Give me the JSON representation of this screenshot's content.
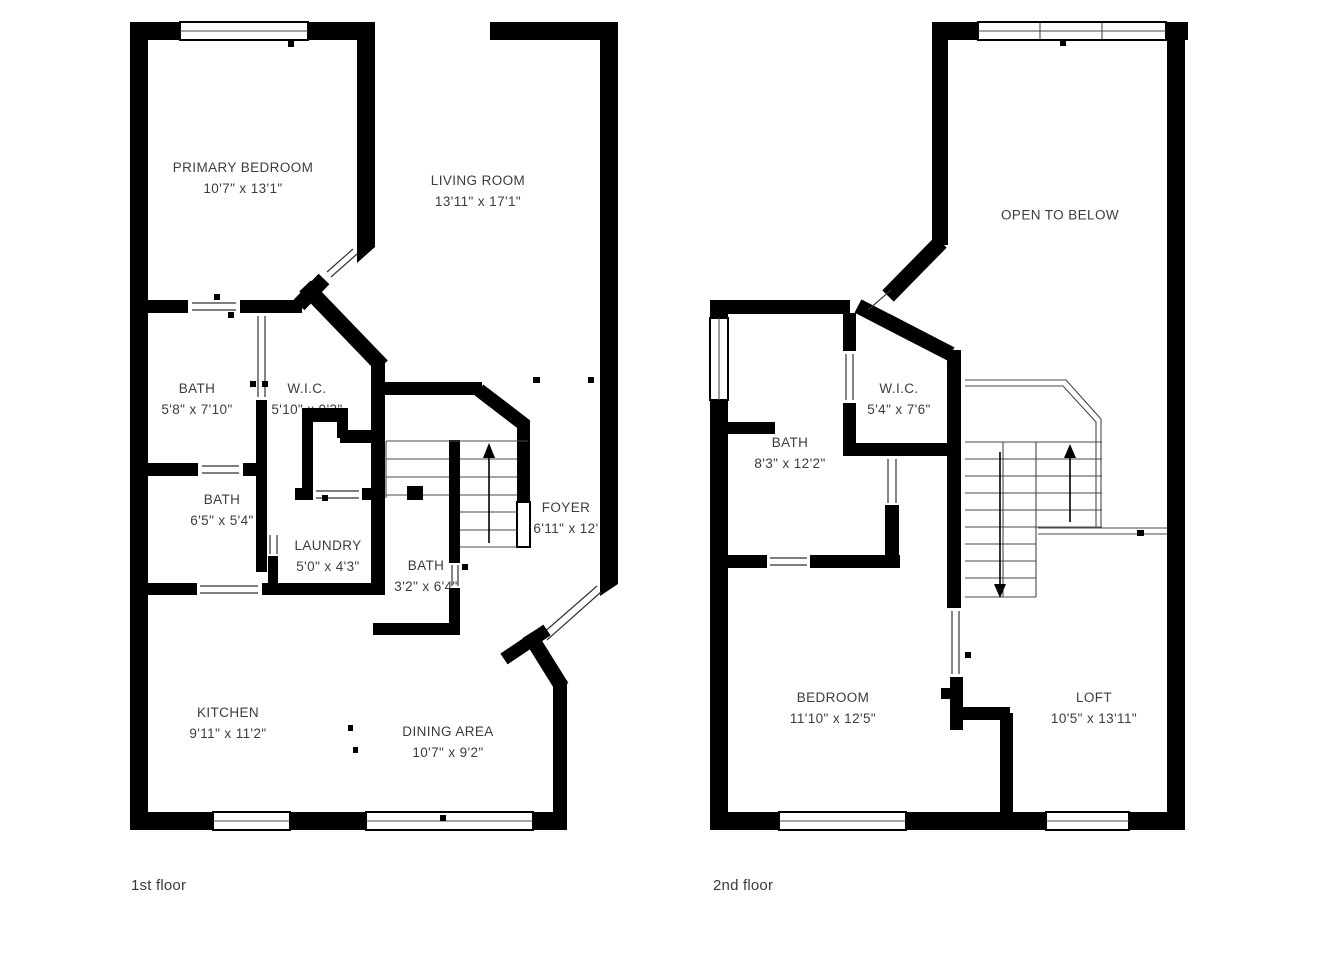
{
  "page": {
    "background": "#ffffff",
    "wall_color": "#000000",
    "text_color": "#3c3c3c"
  },
  "floors": [
    {
      "caption": "1st floor",
      "rooms": [
        {
          "name": "PRIMARY BEDROOM",
          "dims": "10'7\" x 13'1\""
        },
        {
          "name": "LIVING ROOM",
          "dims": "13'11\" x 17'1\""
        },
        {
          "name": "BATH",
          "dims": "5'8\" x 7'10\""
        },
        {
          "name": "W.I.C.",
          "dims": "5'10\" x 9'3\""
        },
        {
          "name": "BATH",
          "dims": "6'5\" x 5'4\""
        },
        {
          "name": "LAUNDRY",
          "dims": "5'0\" x 4'3\""
        },
        {
          "name": "BATH",
          "dims": "3'2\" x 6'4\""
        },
        {
          "name": "FOYER",
          "dims": "6'11\" x 12'"
        },
        {
          "name": "KITCHEN",
          "dims": "9'11\" x 11'2\""
        },
        {
          "name": "DINING AREA",
          "dims": "10'7\" x 9'2\""
        }
      ]
    },
    {
      "caption": "2nd floor",
      "rooms": [
        {
          "name": "OPEN TO BELOW",
          "dims": ""
        },
        {
          "name": "BATH",
          "dims": "8'3\" x 12'2\""
        },
        {
          "name": "W.I.C.",
          "dims": "5'4\" x 7'6\""
        },
        {
          "name": "BEDROOM",
          "dims": "11'10\" x 12'5\""
        },
        {
          "name": "LOFT",
          "dims": "10'5\" x 13'11\""
        }
      ]
    }
  ],
  "icons": {
    "stairs_up_arrow": "triangle-up",
    "stairs_down_arrow": "triangle-down",
    "door_swing_marker": "small-square"
  }
}
